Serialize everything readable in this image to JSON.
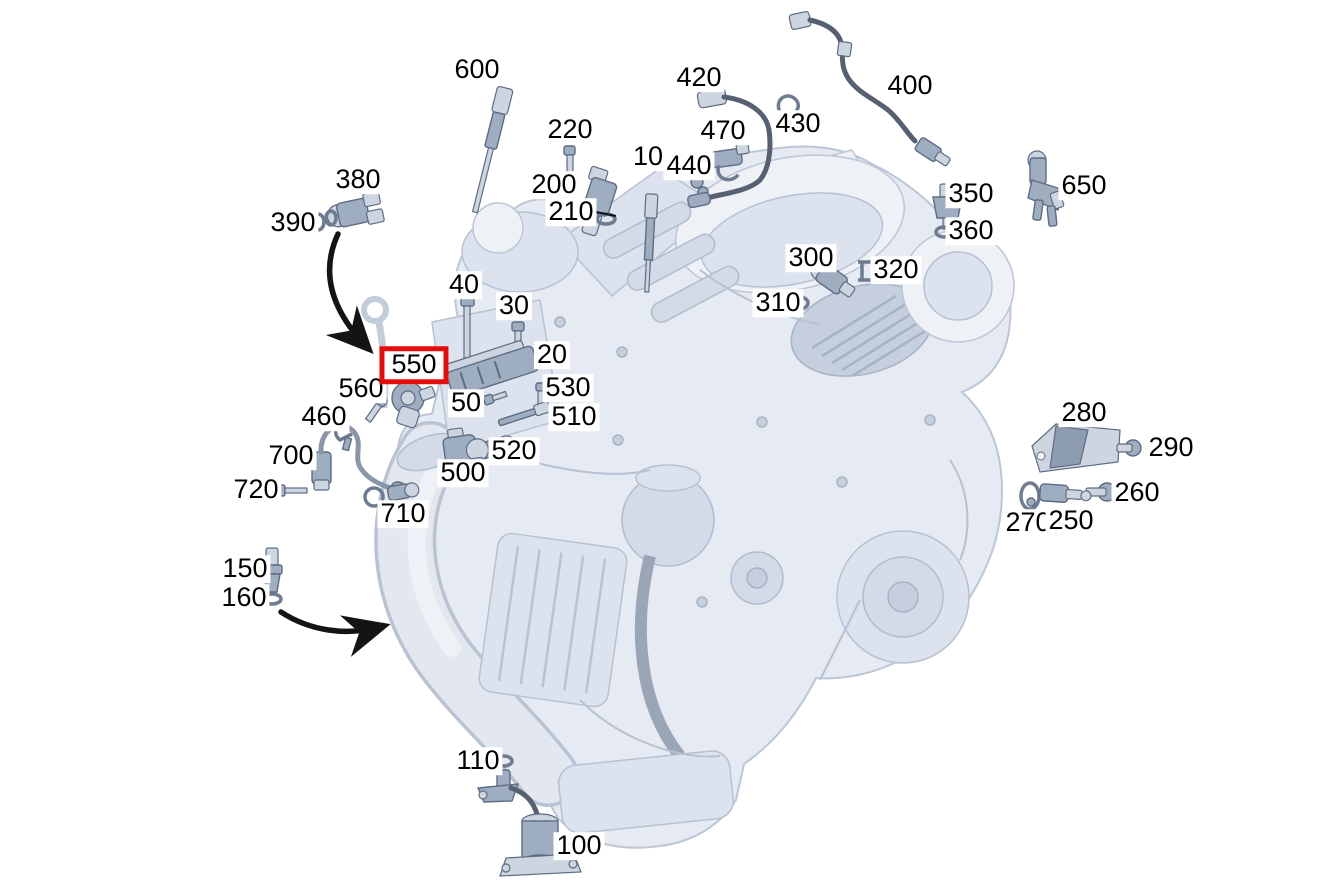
{
  "diagram": {
    "kind": "engine-sensor-parts-diagram",
    "background_color": "#ffffff",
    "label_color": "#000000",
    "highlight_box_color": "#e30d0d",
    "engine_fill_color": "#e6eaf2",
    "engine_stroke_color": "#bcc6d6",
    "part_fill_color": "#9fadc1",
    "cable_color": "#566070",
    "highlighted_callout": "550",
    "callouts": [
      {
        "label": "600",
        "x": 477,
        "y": 70,
        "part": "temperature-probe"
      },
      {
        "label": "420",
        "x": 699,
        "y": 78,
        "part": "exhaust-temp-sensor-harness"
      },
      {
        "label": "400",
        "x": 910,
        "y": 86,
        "part": "oxygen-sensor-cable"
      },
      {
        "label": "430",
        "x": 798,
        "y": 124,
        "part": "cable-clip"
      },
      {
        "label": "470",
        "x": 723,
        "y": 131,
        "part": "sensor-clamp"
      },
      {
        "label": "220",
        "x": 570,
        "y": 130,
        "part": "bolt"
      },
      {
        "label": "10",
        "x": 648,
        "y": 157,
        "part": "glow-plug"
      },
      {
        "label": "440",
        "x": 689,
        "y": 166,
        "part": "nut"
      },
      {
        "label": "650",
        "x": 1084,
        "y": 186,
        "part": "pressure-sensor"
      },
      {
        "label": "200",
        "x": 554,
        "y": 185,
        "part": "camshaft-sensor"
      },
      {
        "label": "380",
        "x": 358,
        "y": 180,
        "part": "coolant-sensor"
      },
      {
        "label": "350",
        "x": 971,
        "y": 194,
        "part": "temperature-sensor"
      },
      {
        "label": "210",
        "x": 571,
        "y": 212,
        "part": "o-ring"
      },
      {
        "label": "390",
        "x": 293,
        "y": 223,
        "part": "o-ring"
      },
      {
        "label": "360",
        "x": 971,
        "y": 231,
        "part": "seal-ring"
      },
      {
        "label": "300",
        "x": 811,
        "y": 258,
        "part": "sensor"
      },
      {
        "label": "320",
        "x": 896,
        "y": 270,
        "part": "retaining-clip"
      },
      {
        "label": "40",
        "x": 464,
        "y": 285,
        "part": "long-bolt"
      },
      {
        "label": "310",
        "x": 778,
        "y": 303,
        "part": "o-ring"
      },
      {
        "label": "30",
        "x": 514,
        "y": 306,
        "part": "bolt"
      },
      {
        "label": "20",
        "x": 552,
        "y": 355,
        "part": "control-module"
      },
      {
        "label": "550",
        "x": 414,
        "y": 365,
        "part": "camshaft-hall-sensor",
        "highlighted": true
      },
      {
        "label": "530",
        "x": 568,
        "y": 388,
        "part": "bolt"
      },
      {
        "label": "560",
        "x": 361,
        "y": 389,
        "part": "bolt"
      },
      {
        "label": "50",
        "x": 466,
        "y": 403,
        "part": "bolt"
      },
      {
        "label": "280",
        "x": 1084,
        "y": 413,
        "part": "bracket"
      },
      {
        "label": "510",
        "x": 574,
        "y": 417,
        "part": "probe"
      },
      {
        "label": "460",
        "x": 324,
        "y": 417,
        "part": "holder-clip"
      },
      {
        "label": "290",
        "x": 1171,
        "y": 448,
        "part": "bolt"
      },
      {
        "label": "520",
        "x": 514,
        "y": 451,
        "part": "sensor"
      },
      {
        "label": "700",
        "x": 291,
        "y": 456,
        "part": "oxygen-sensor"
      },
      {
        "label": "500",
        "x": 463,
        "y": 473,
        "part": "sensor"
      },
      {
        "label": "720",
        "x": 256,
        "y": 490,
        "part": "bolt"
      },
      {
        "label": "260",
        "x": 1137,
        "y": 493,
        "part": "bolt"
      },
      {
        "label": "710",
        "x": 403,
        "y": 514,
        "part": "seal-plug"
      },
      {
        "label": "270",
        "x": 1028,
        "y": 523,
        "part": "clamp"
      },
      {
        "label": "250",
        "x": 1071,
        "y": 521,
        "part": "sensor"
      },
      {
        "label": "150",
        "x": 245,
        "y": 569,
        "part": "oil-sensor"
      },
      {
        "label": "160",
        "x": 244,
        "y": 598,
        "part": "seal-washer"
      },
      {
        "label": "110",
        "x": 478,
        "y": 761,
        "part": "o-ring"
      },
      {
        "label": "100",
        "x": 579,
        "y": 846,
        "part": "oil-level-sensor"
      }
    ],
    "annotations": [
      {
        "name": "arrow-380-to-550",
        "type": "curved-arrow"
      },
      {
        "name": "arrow-160-to-engine",
        "type": "curved-arrow"
      }
    ]
  }
}
